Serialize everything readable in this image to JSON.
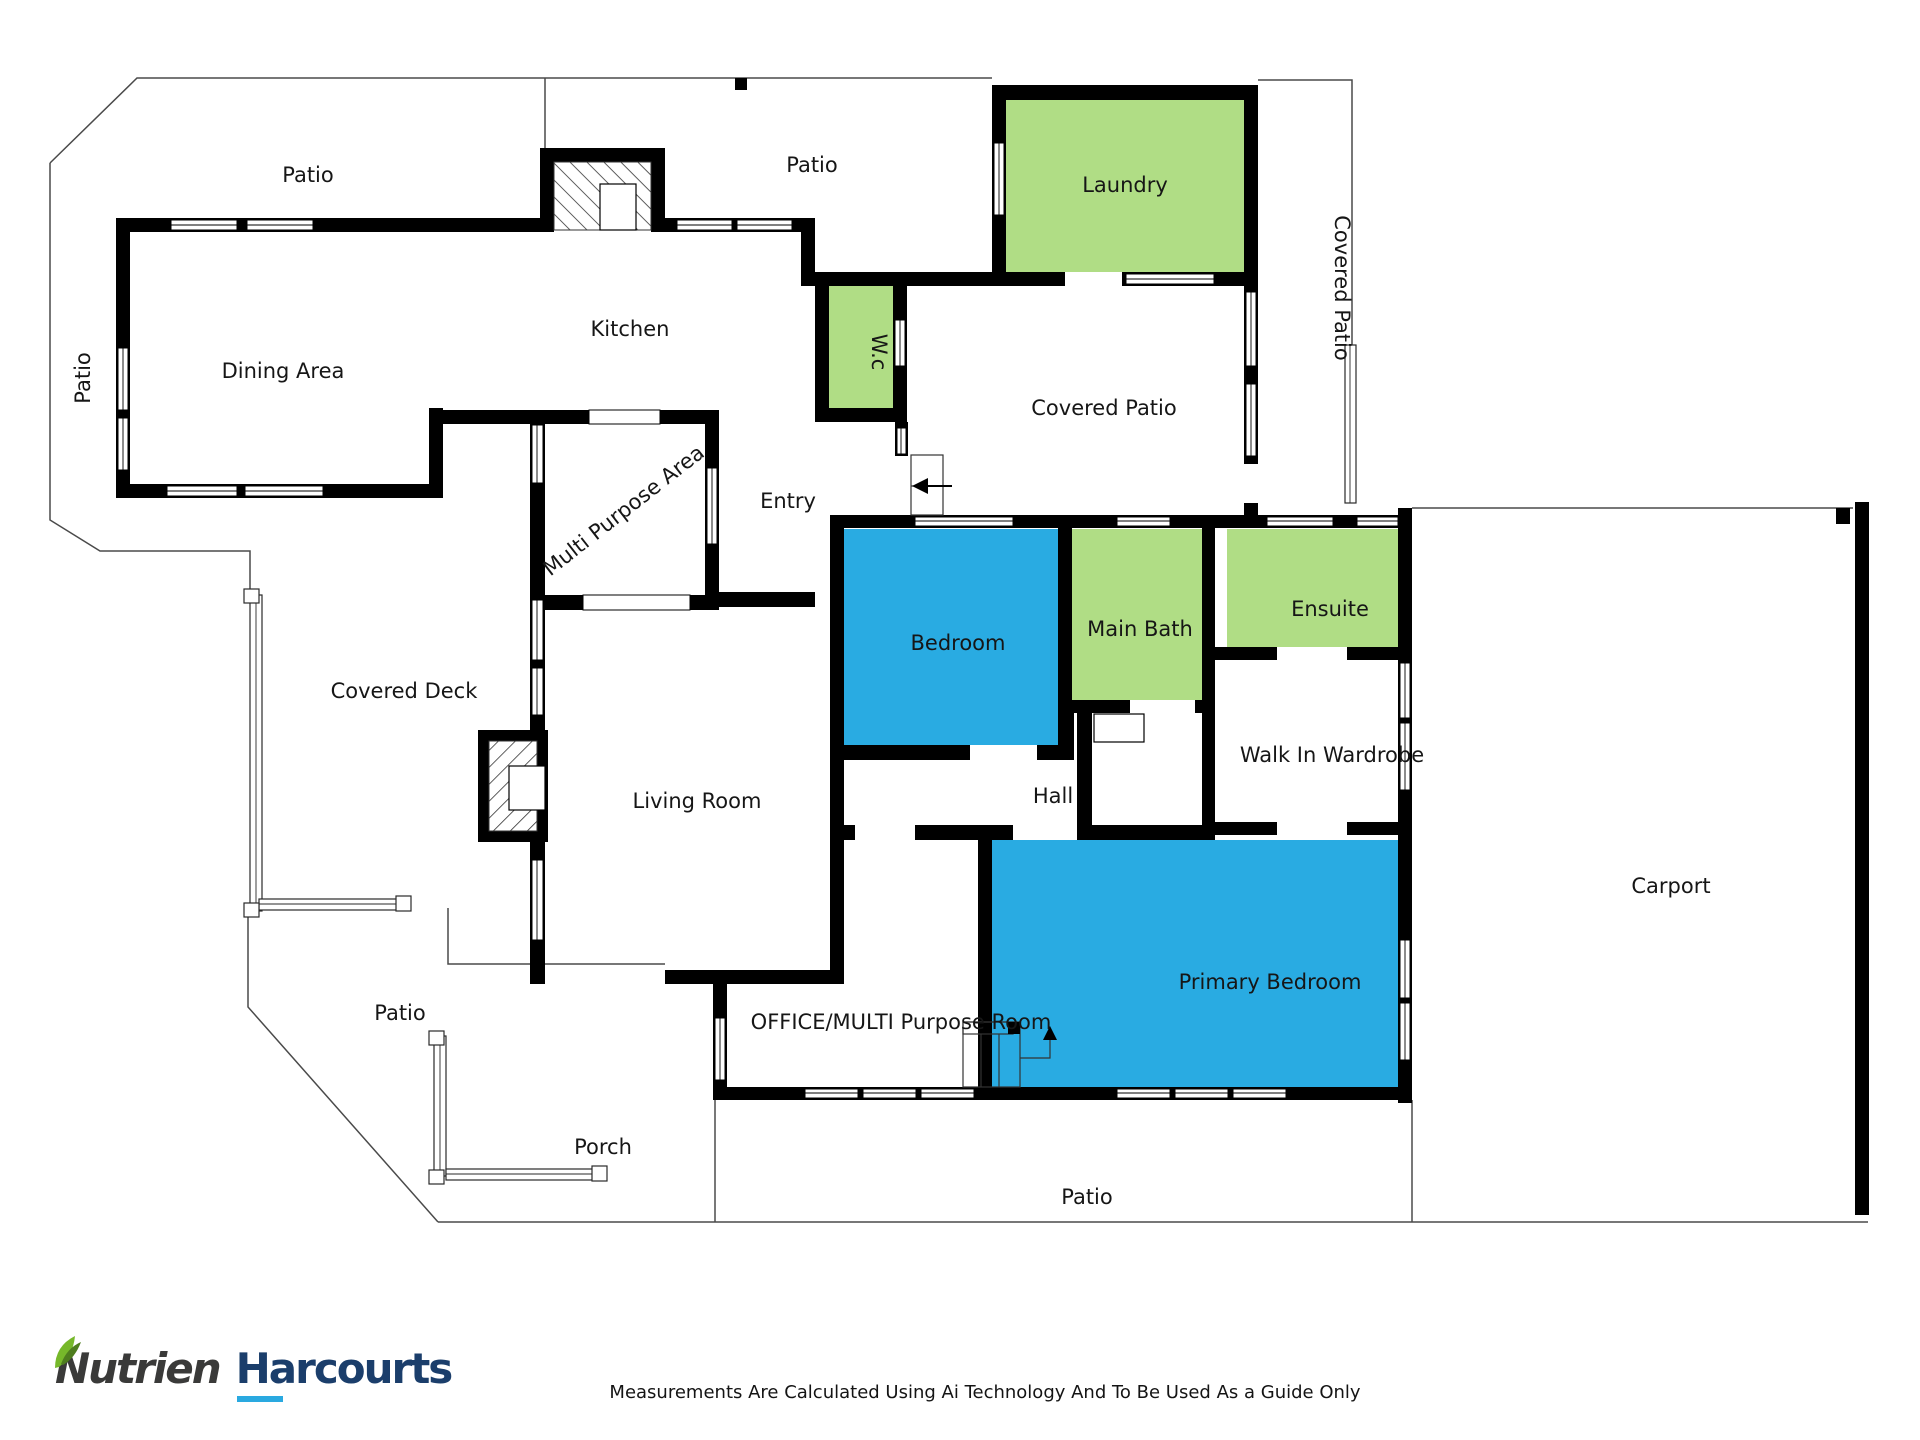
{
  "labels": {
    "patio_top_left": "Patio",
    "patio_top_mid": "Patio",
    "laundry": "Laundry",
    "covered_patio_side": "Covered Patio",
    "patio_left": "Patio",
    "dining_area": "Dining Area",
    "kitchen": "Kitchen",
    "wc": "W.c",
    "covered_patio": "Covered Patio",
    "entry": "Entry",
    "multi_purpose_area": "Multi Purpose Area",
    "bedroom": "Bedroom",
    "main_bath": "Main Bath",
    "ensuite": "Ensuite",
    "covered_deck": "Covered Deck",
    "living_room": "Living Room",
    "hall": "Hall",
    "walk_in_wardrobe": "Walk In Wardrobe",
    "carport": "Carport",
    "patio_bottom_left": "Patio",
    "primary_bedroom": "Primary Bedroom",
    "office": "OFFICE/MULTI Purpose Room",
    "porch": "Porch",
    "patio_bottom": "Patio"
  },
  "branding": {
    "brand_primary": "Nutrien",
    "brand_secondary": "Harcourts"
  },
  "footer": {
    "disclaimer": "Measurements Are Calculated Using Ai Technology And To Be Used As a Guide Only"
  },
  "colors": {
    "room_green": "#b0dd85",
    "room_blue": "#29abe2",
    "wall": "#000000",
    "outline": "#4a4a4a",
    "brand_navy": "#1b3e6b",
    "brand_charcoal": "#3a3a39",
    "brand_underline": "#2aa9e0",
    "leaf_green": "#76b82a",
    "leaf_green_dark": "#4e7d1e"
  }
}
